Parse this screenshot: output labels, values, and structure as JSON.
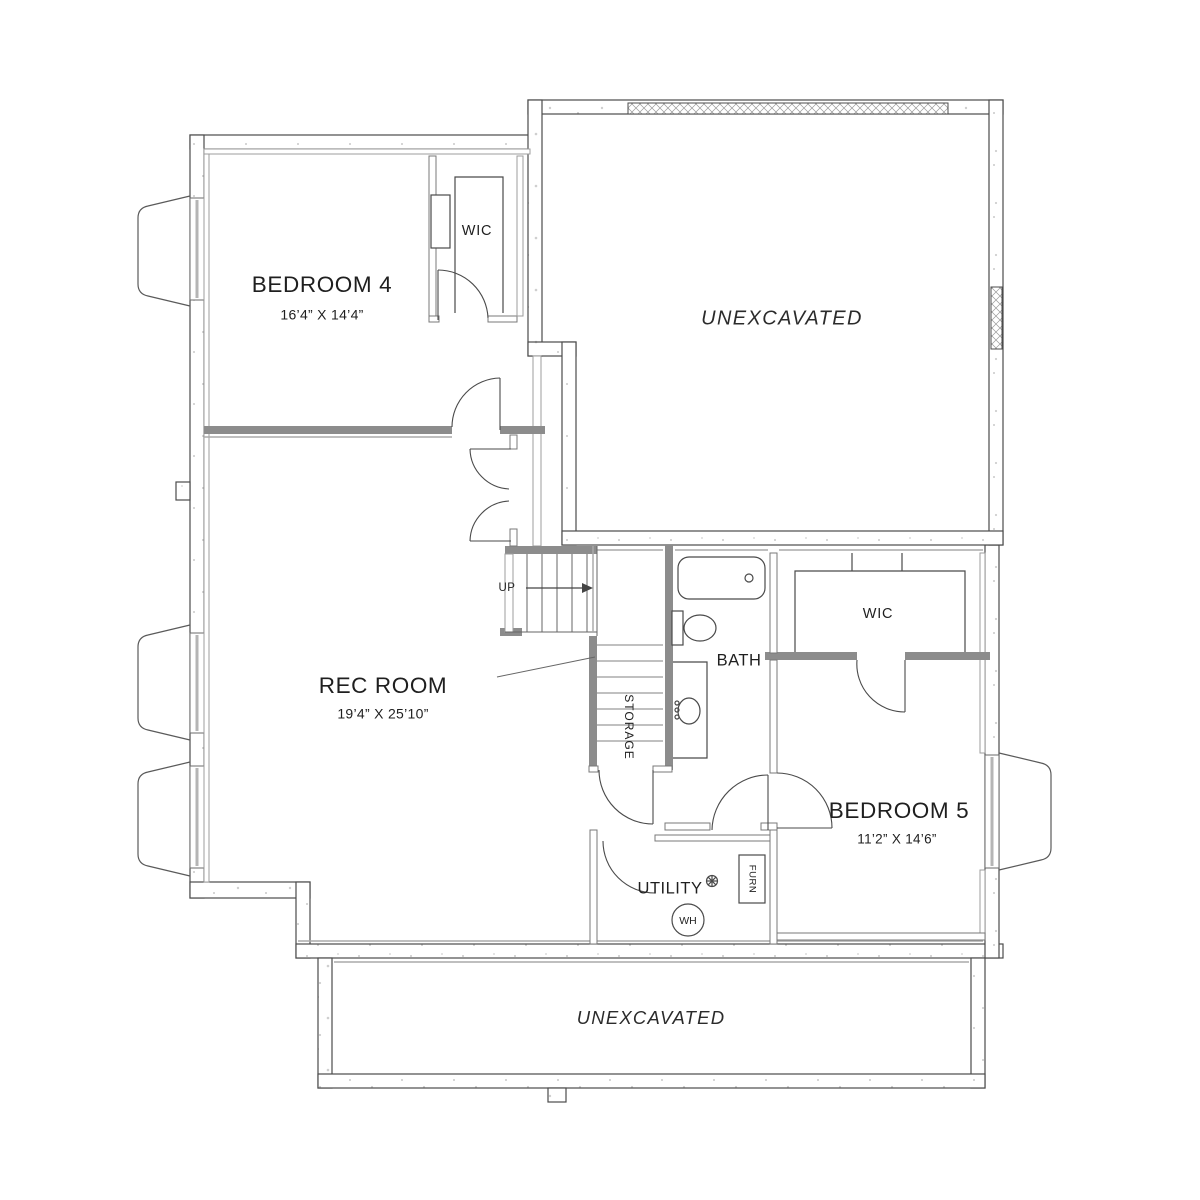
{
  "title": "Basement floor plan",
  "rooms": {
    "bedroom4": {
      "name": "BEDROOM 4",
      "dims": "16’4” X 14’4”"
    },
    "wic_top": {
      "name": "WIC"
    },
    "unexcavated_top": {
      "name": "UNEXCAVATED"
    },
    "rec_room": {
      "name": "REC ROOM",
      "dims": "19’4” X 25’10”"
    },
    "storage": {
      "name": "STORAGE"
    },
    "bath": {
      "name": "BATH"
    },
    "wic_bedroom5": {
      "name": "WIC"
    },
    "bedroom5": {
      "name": "BEDROOM 5",
      "dims": "11’2” X 14’6”"
    },
    "utility": {
      "name": "UTILITY"
    },
    "unexcavated_bottom": {
      "name": "UNEXCAVATED"
    }
  },
  "annotations": {
    "up": "UP",
    "water_heater": "WH",
    "furnace": "FURN"
  },
  "icons": {
    "floor_drain": "floor-drain-icon",
    "up_arrow": "up-direction-arrow"
  },
  "colors": {
    "wall_line": "#4b4b4b",
    "bearing_wall": "#8c8c8c",
    "furring_line": "#a8a8a8",
    "window_glass": "#b5b5b5",
    "fixture_line": "#4a4a4a",
    "text": "#1f1f1f",
    "background": "#ffffff"
  }
}
